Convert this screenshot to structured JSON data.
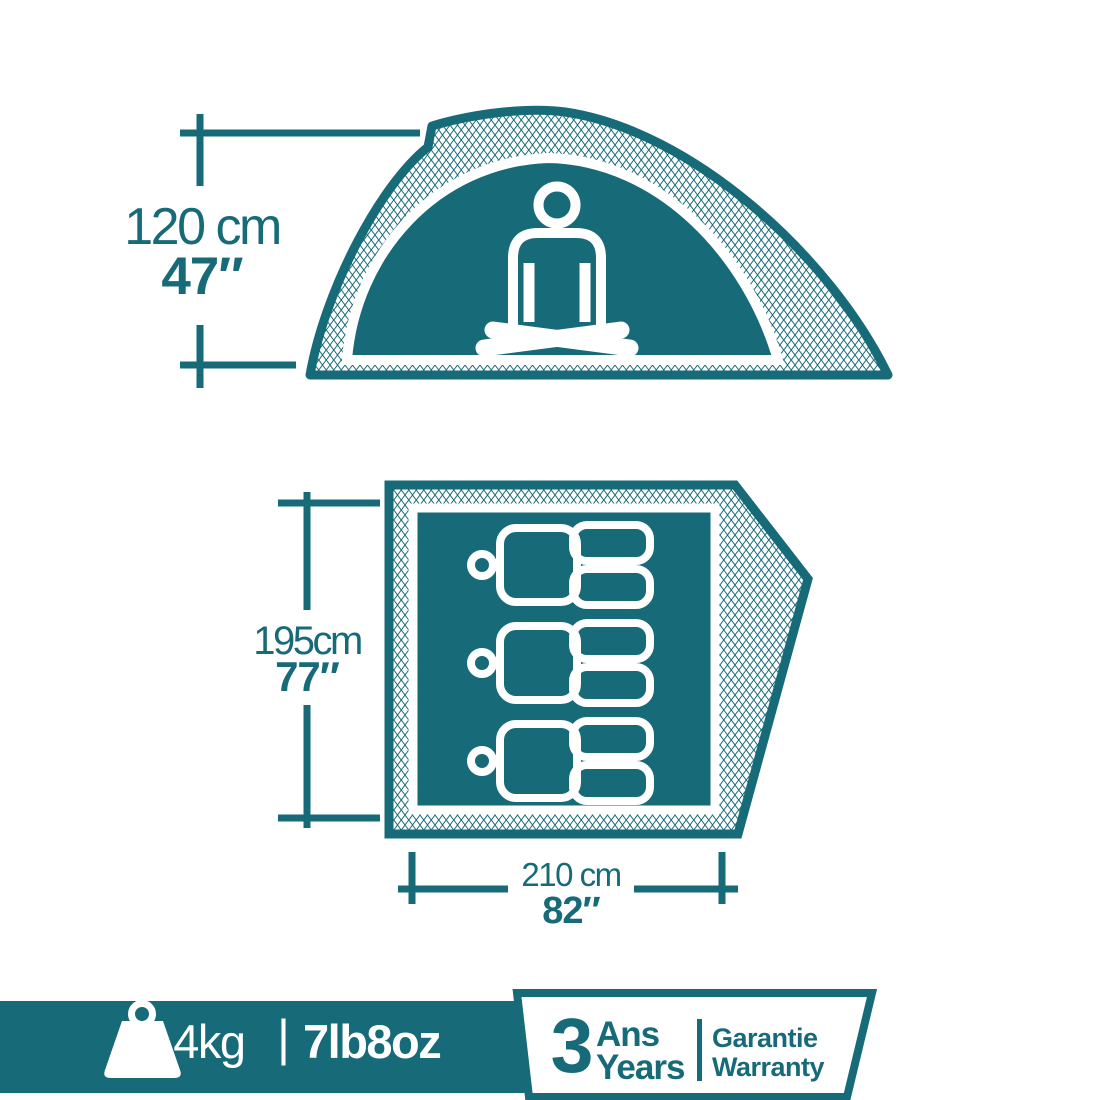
{
  "colors": {
    "teal": "#176A77",
    "background": "#FFFFFF"
  },
  "side_view": {
    "height_metric": "120 cm",
    "height_imperial": "47″"
  },
  "floor_plan": {
    "capacity_persons": 3,
    "depth_metric": "195cm",
    "depth_imperial": "77″",
    "width_metric": "210 cm",
    "width_imperial": "82″"
  },
  "footer": {
    "weight_metric": "3,4kg",
    "separator": "|",
    "weight_imperial": "7lb8oz",
    "warranty": {
      "years_count": "3",
      "years_label_fr": "Ans",
      "years_label_en": "Years",
      "warranty_label_fr": "Garantie",
      "warranty_label_en": "Warranty"
    }
  }
}
